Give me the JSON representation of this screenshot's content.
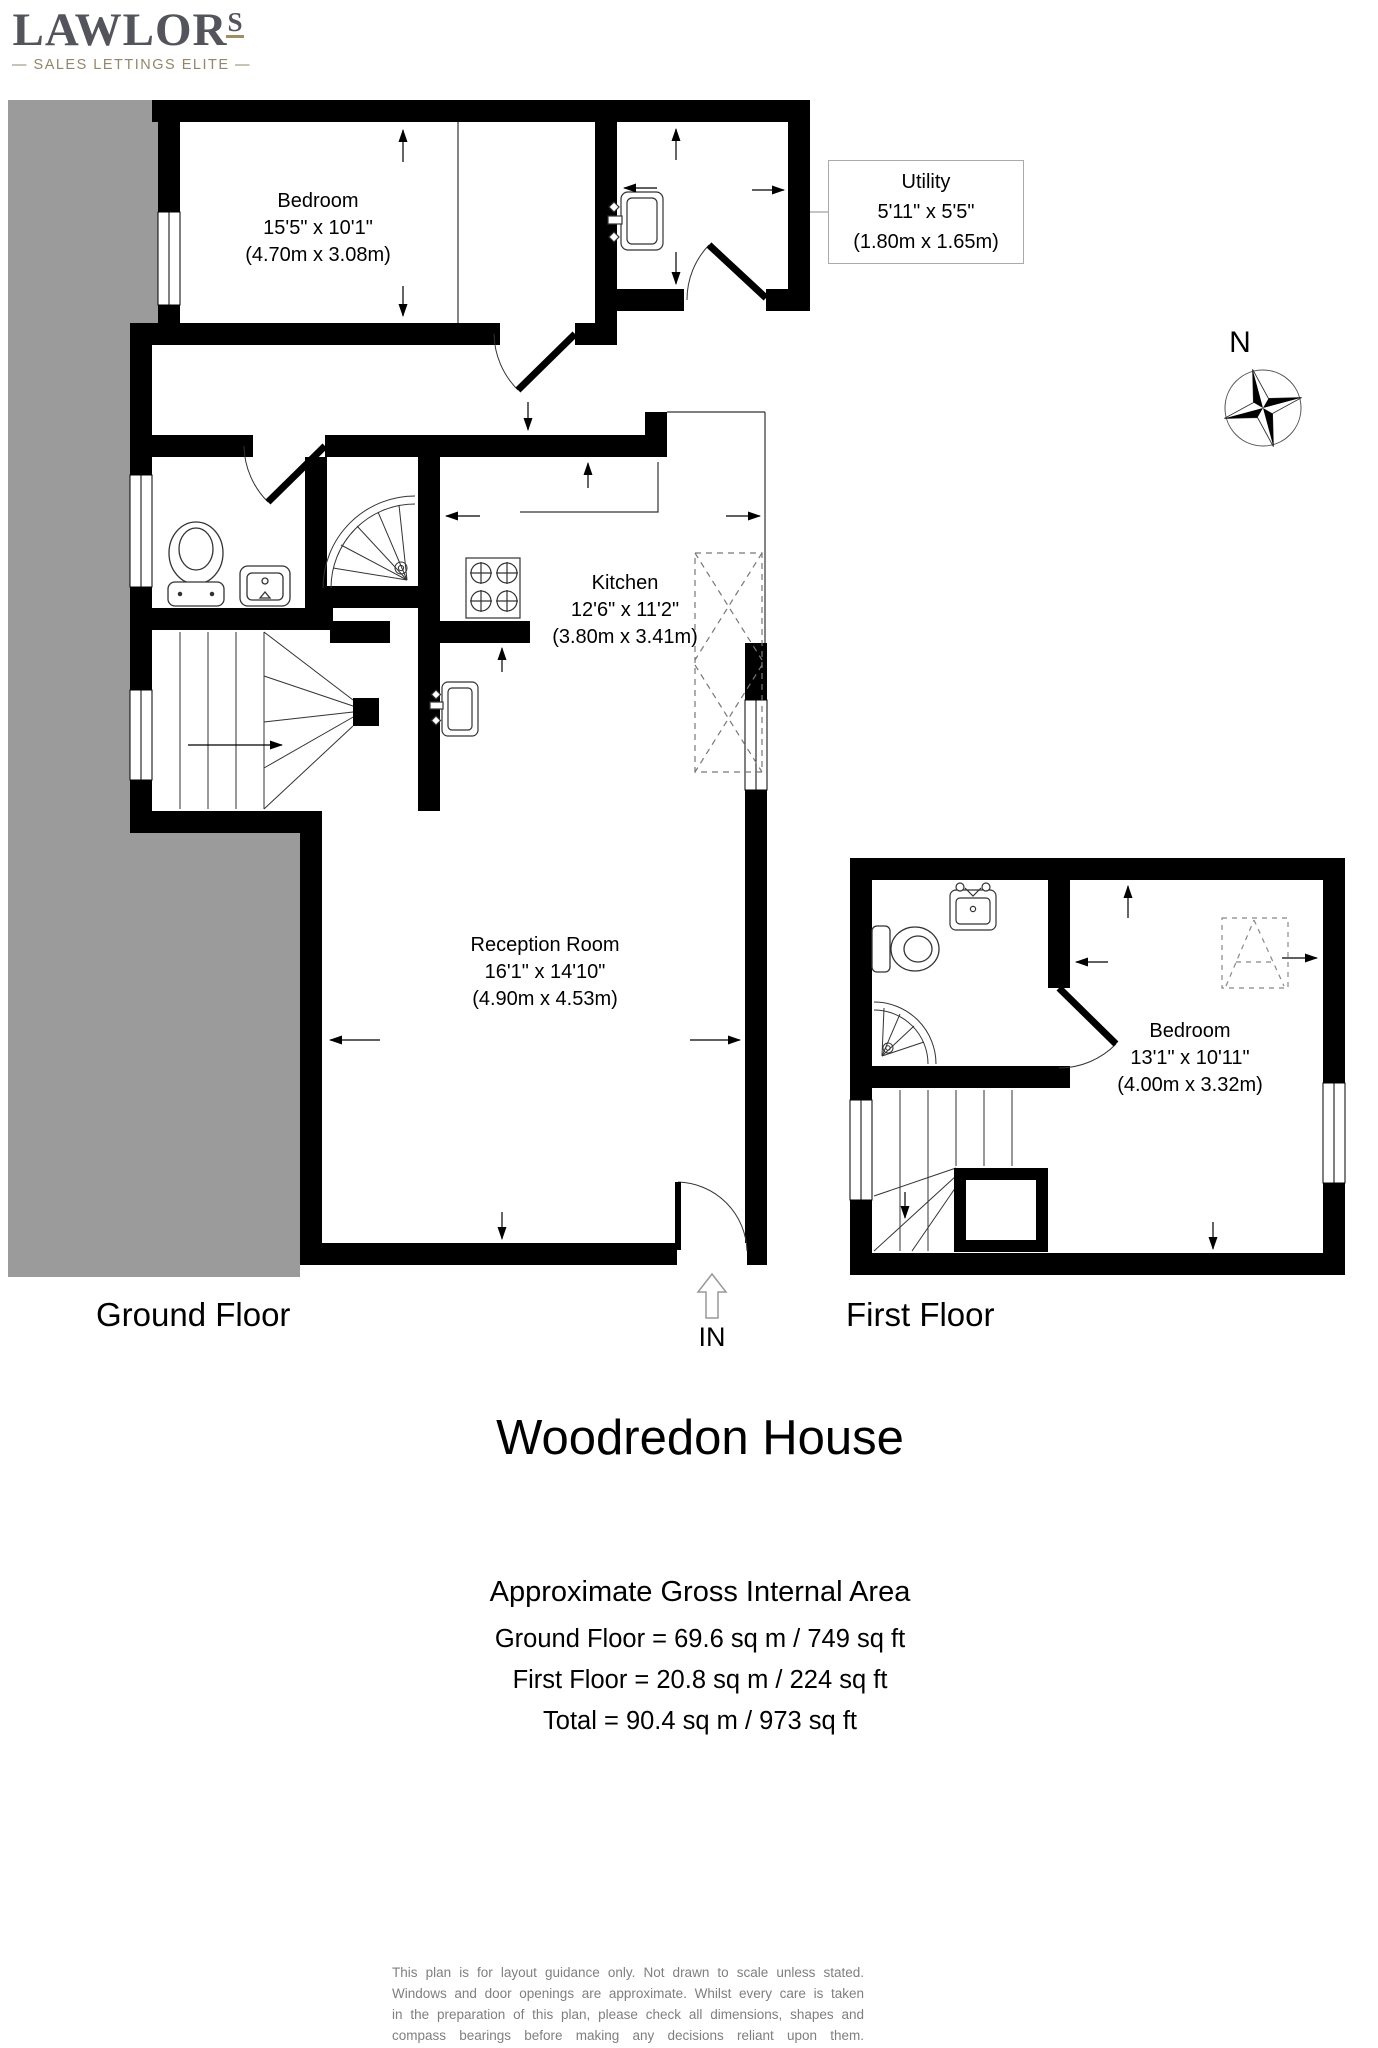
{
  "logo": {
    "name": "LAWLOR",
    "s": "S",
    "tagline": "— SALES  LETTINGS  ELITE —"
  },
  "compass": {
    "label": "N"
  },
  "floors": {
    "ground": {
      "label": "Ground Floor"
    },
    "first": {
      "label": "First Floor"
    }
  },
  "rooms": {
    "gf_bedroom": {
      "name": "Bedroom",
      "imperial": "15'5\" x 10'1\"",
      "metric": "(4.70m x 3.08m)"
    },
    "utility": {
      "name": "Utility",
      "imperial": "5'11\" x 5'5\"",
      "metric": "(1.80m x 1.65m)"
    },
    "kitchen": {
      "name": "Kitchen",
      "imperial": "12'6\" x 11'2\"",
      "metric": "(3.80m x 3.41m)"
    },
    "reception": {
      "name": "Reception Room",
      "imperial": "16'1\" x 14'10\"",
      "metric": "(4.90m x 4.53m)"
    },
    "ff_bedroom": {
      "name": "Bedroom",
      "imperial": "13'1\" x 10'11\"",
      "metric": "(4.00m x 3.32m)"
    }
  },
  "entrance": {
    "label": "IN"
  },
  "title": "Woodredon House",
  "areas": {
    "heading": "Approximate Gross Internal Area",
    "ground": "Ground Floor = 69.6 sq m / 749 sq ft",
    "first": "First Floor = 20.8 sq m / 224 sq ft",
    "total": "Total = 90.4 sq m / 973 sq ft"
  },
  "disclaimer": {
    "lines": [
      "This plan is for layout guidance only. Not drawn to scale unless stated.",
      "Windows and door openings are approximate. Whilst every care is taken",
      "in the preparation of this plan, please check all dimensions, shapes and",
      "compass bearings before making any decisions reliant upon them."
    ]
  },
  "colors": {
    "wall": "#000000",
    "neighbor_fill": "#9b9b9b",
    "logo_text": "#54545c",
    "logo_accent": "#93866c",
    "disclaimer_text": "#7f7f7f"
  }
}
